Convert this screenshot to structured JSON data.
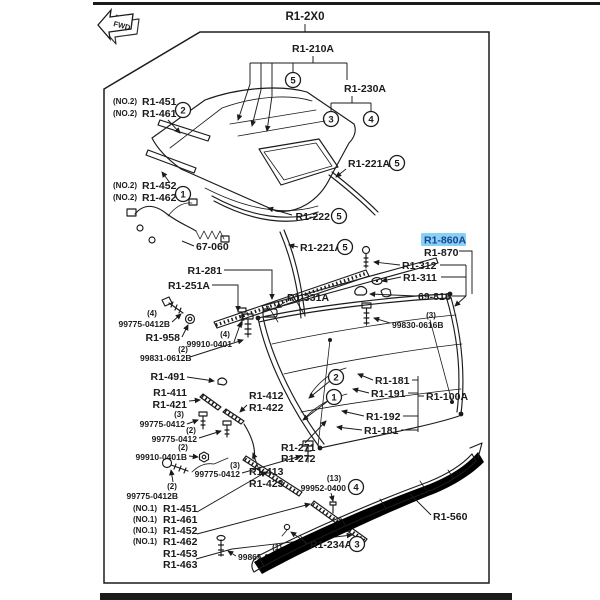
{
  "colors": {
    "ink": "#1b1b1b",
    "paper": "#ffffff",
    "highlight_bg": "#86d2f0",
    "highlight_text": "#1c3f9a"
  },
  "frame": {
    "fwd": "FWD"
  },
  "parts": {
    "root": "R1-2X0",
    "group_top": "R1-210A",
    "group_rear": "R1-230A",
    "no2": "(NO.2)",
    "no1": "(NO.1)",
    "q1": "(1)",
    "q2": "(2)",
    "q3": "(3)",
    "q4": "(4)",
    "q13": "(13)",
    "r1_451": "R1-451",
    "r1_461": "R1-461",
    "r1_452": "R1-452",
    "r1_462": "R1-462",
    "p67_060": "67-060",
    "r1_221a": "R1-221A",
    "r1_222": "R1-222",
    "r1_281": "R1-281",
    "r1_251a": "R1-251A",
    "r1_331a": "R1-331A",
    "n99775_0412b": "99775-0412B",
    "r1_958": "R1-958",
    "n99910_0401": "99910-0401",
    "n99831_0612b": "99831-0612B",
    "r1_860a": "R1-860A",
    "r1_870": "R1-870",
    "r1_312": "R1-312",
    "r1_311": "R1-311",
    "p69_818": "69-818",
    "n99830_0616b": "99830-0616B",
    "r1_181": "R1-181",
    "r1_191": "R1-191",
    "r1_100a": "R1-100A",
    "r1_192": "R1-192",
    "r1_491": "R1-491",
    "r1_411": "R1-411",
    "r1_421": "R1-421",
    "r1_412": "R1-412",
    "r1_422": "R1-422",
    "n99775_0412": "99775-0412",
    "n99910_0401b": "99910-0401B",
    "r1_271": "R1-271",
    "r1_272": "R1-272",
    "r1_413": "R1-413",
    "r1_423": "R1-423",
    "r1_453": "R1-453",
    "r1_463": "R1-463",
    "n99865_0412b": "99865-0412B",
    "n99952_0400": "99952-0400",
    "r1_234a": "R1-234A",
    "r1_560": "R1-560"
  },
  "callouts": {
    "n1": "1",
    "n2": "2",
    "n3": "3",
    "n4": "4",
    "n5": "5"
  }
}
